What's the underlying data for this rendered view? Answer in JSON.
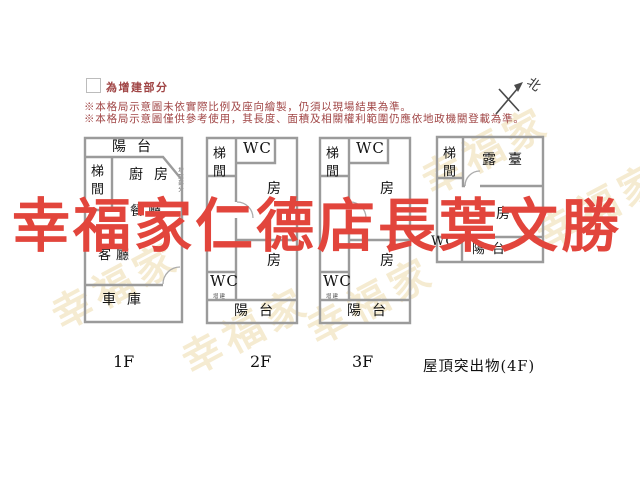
{
  "legend": {
    "label": "為增建部分"
  },
  "notes": {
    "line1": "※本格局示意圖未依實際比例及座向繪製，仍須以現場結果為準。",
    "line2": "※本格局示意圖僅供參考使用，其長度、面積及相關權利範圍仍應依地政機關登載為準。"
  },
  "compass": {
    "label": "北"
  },
  "watermark": {
    "text": "幸福家仁德店長葉文勝",
    "brand": "幸福家",
    "color": "#e2453c"
  },
  "floors": {
    "f1": {
      "label": "1F",
      "balcony": "陽台",
      "stairwell": "梯間",
      "kitchen": "廚房",
      "dining": "餐廳",
      "living": "客廳",
      "garage": "車庫",
      "annotation": "增建部分"
    },
    "f2": {
      "label": "2F",
      "stairwell": "梯間",
      "wc_top": "WC",
      "room_upper": "房",
      "room_lower": "房",
      "wc_bottom": "WC",
      "wc_note": "增建",
      "balcony": "陽台"
    },
    "f3": {
      "label": "3F",
      "stairwell": "梯間",
      "wc_top": "WC",
      "room_upper": "房",
      "room_lower": "房",
      "wc_bottom": "WC",
      "wc_note": "增建",
      "balcony": "陽台"
    },
    "f4": {
      "label": "屋頂突出物(4F)",
      "stairwell": "梯間",
      "terrace": "露臺",
      "room": "房",
      "wc": "WC",
      "balcony": "陽台"
    }
  },
  "colors": {
    "wall": "#9b9b9b",
    "note_text": "#a04545",
    "room_text": "#141414",
    "watermark_red": "#e2453c",
    "brand_cream": "#eddcad"
  }
}
